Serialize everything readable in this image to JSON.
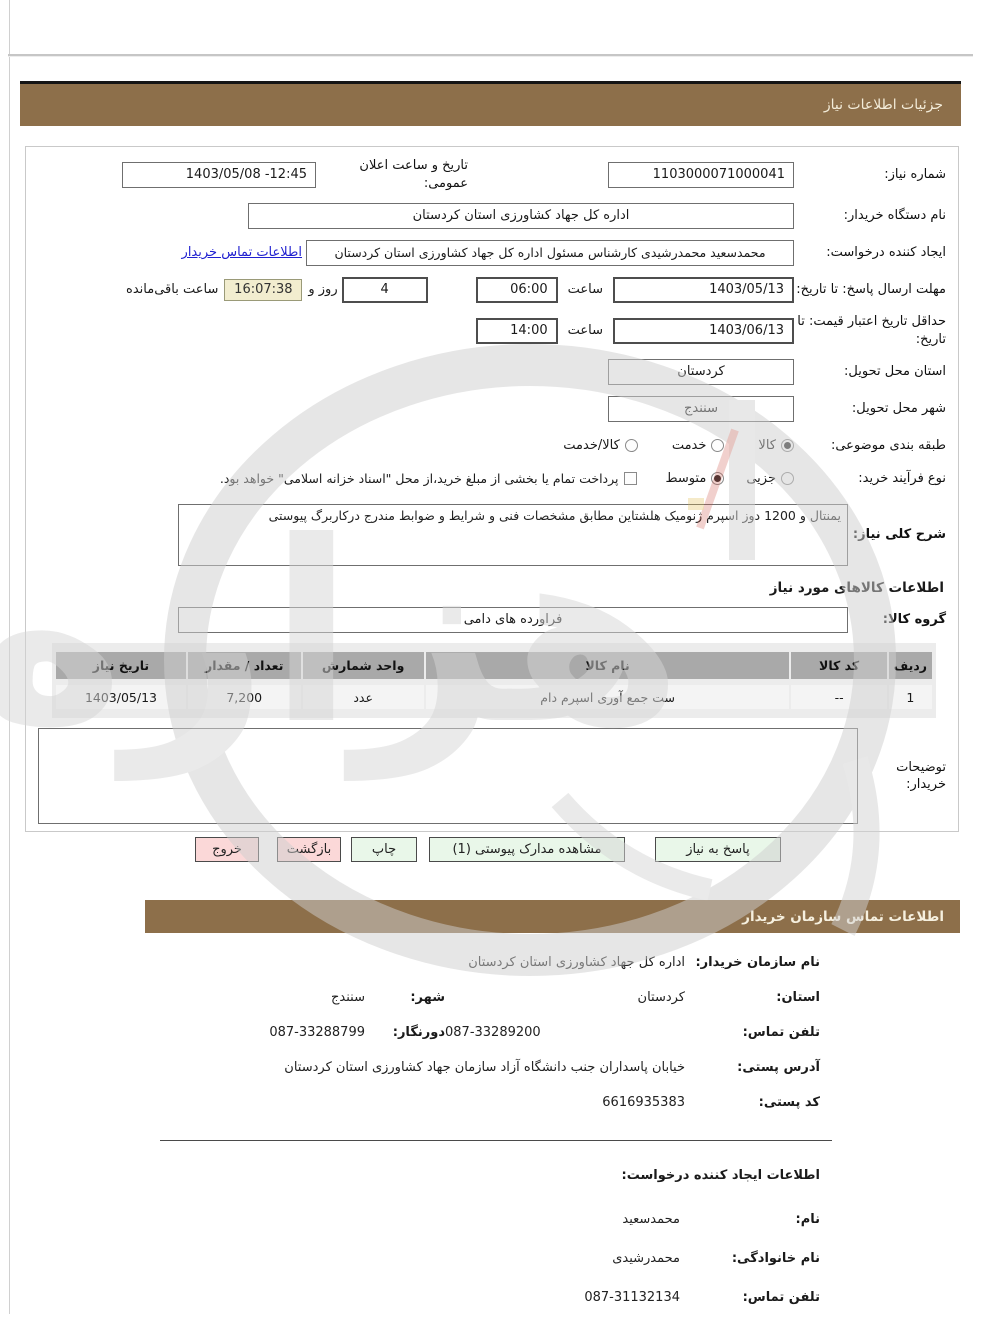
{
  "header": {
    "title": "جزئیات اطلاعات نیاز"
  },
  "colors": {
    "header_bg": "#8d6f4a",
    "button_green": "#e9f7e9",
    "button_pink": "#fbd8d8",
    "countdown_bg": "#f2edcf",
    "link_blue": "#1f1fd0",
    "table_header_bg": "#a9a9a9"
  },
  "form": {
    "need_number_label": "شماره نیاز:",
    "need_number": "1103000071000041",
    "announce_label": "تاریخ و ساعت اعلان عمومی:",
    "announce_value": "1403/05/08 -12:45",
    "org_label": "نام دستگاه خریدار:",
    "org_value": "اداره کل جهاد کشاورزی استان کردستان",
    "creator_label": "ایجاد کننده درخواست:",
    "creator_value": "محمدسعید محمدرشیدی کارشناس مسئول اداره کل جهاد کشاورزی استان کردستان",
    "creator_link": "اطلاعات تماس خریدار",
    "deadline_label": "مهلت ارسال پاسخ: تا تاریخ:",
    "deadline_date": "1403/05/13",
    "hour_label": "ساعت",
    "deadline_time": "06:00",
    "remaining_days": "4",
    "days_and_label": "روز و",
    "countdown": "16:07:38",
    "remaining_label": "ساعت باقی‌مانده",
    "validity_label": "حداقل تاریخ اعتبار قیمت: تا تاریخ:",
    "validity_date": "1403/06/13",
    "validity_time": "14:00",
    "province_label": "استان محل تحویل:",
    "province_value": "کردستان",
    "city_label": "شهر محل تحویل:",
    "city_value": "سنندج",
    "subject_label": "طبقه بندی موضوعی:",
    "subject_options": [
      {
        "label": "کالا",
        "checked": true
      },
      {
        "label": "خدمت",
        "checked": false
      },
      {
        "label": "کالا/خدمت",
        "checked": false
      }
    ],
    "process_label": "نوع فرآیند خرید:",
    "process_options": [
      {
        "label": "جزیی",
        "checked": false
      },
      {
        "label": "متوسط",
        "checked": true
      }
    ],
    "treasury_checkbox_label": "پرداخت تمام یا بخشی از مبلغ خرید،از محل \"اسناد خزانه اسلامی\" خواهد بود.",
    "treasury_checkbox_checked": false,
    "description_label": "شرح کلی نیاز:",
    "description_value": "یمنتال و 1200 دوز اسپرم ژنومیک هلشتاین مطابق مشخصات فنی و شرایط و ضوابط مندرج درکاربرگ پیوستی",
    "goods_section_title": "اطلاعات کالاهای مورد نیاز",
    "goods_group_label": "گروه کالا:",
    "goods_group_value": "فراورده های دامی",
    "notes_label": "توضیحات خریدار:",
    "notes_value": ""
  },
  "goods_table": {
    "headers": [
      "ردیف",
      "کد کالا",
      "نام کالا",
      "واحد شمارش",
      "تعداد / مقدار",
      "تاریخ نیاز"
    ],
    "rows": [
      {
        "row_no": "1",
        "item_code": "--",
        "item_name": "ست جمع آوری اسپرم دام",
        "unit": "عدد",
        "quantity": "7,200",
        "need_date": "1403/05/13"
      }
    ]
  },
  "buttons": {
    "respond": "پاسخ به نیاز",
    "view_attachments": "مشاهده مدارک پیوستی (1)",
    "print": "چاپ",
    "back": "بازگشت",
    "exit": "خروج"
  },
  "contact": {
    "title": "اطلاعات تماس سازمان خریدار",
    "org_label": "نام سازمان خریدار:",
    "org_value": "اداره کل جهاد کشاورزی استان کردستان",
    "province_label": "استان:",
    "province_value": "کردستان",
    "city_label": "شهر:",
    "city_value": "سنندج",
    "phone_label": "تلفن تماس:",
    "phone_value": "087-33289200",
    "fax_label": "دورنگار:",
    "fax_value": "087-33288799",
    "address_label": "آدرس پستی:",
    "address_value": "خیابان پاسداران جنب دانشگاه آزاد سازمان جهاد کشاورزی استان کردستان",
    "postal_label": "کد پستی:",
    "postal_value": "6616935383"
  },
  "creator_info": {
    "title": "اطلاعات ایجاد کننده درخواست:",
    "first_name_label": "نام:",
    "first_name": "محمدسعید",
    "last_name_label": "نام خانوادگی:",
    "last_name": "محمدرشیدی",
    "phone_label": "تلفن تماس:",
    "phone": "087-31132134"
  }
}
